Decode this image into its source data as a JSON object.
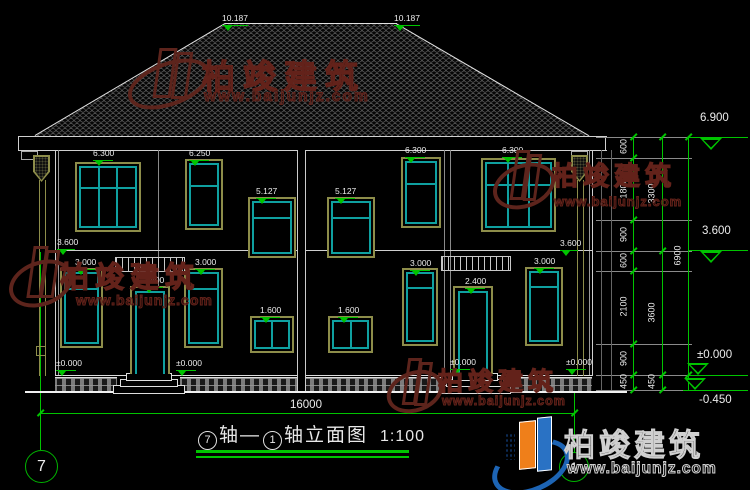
{
  "title": {
    "axis_left": "7",
    "joiner": "轴—",
    "axis_right": "1",
    "suffix": "轴立面图",
    "scale": "1:100"
  },
  "watermark": {
    "brand": "柏竣建筑",
    "url": "www.baijunjz.com"
  },
  "axis_bubbles": {
    "left": "7",
    "right": "1"
  },
  "colors": {
    "dim_green": "#00c400",
    "window_teal": "#0fa0a0",
    "frame_olive": "#8d8d4a",
    "watermark_maroon": "#5d241c",
    "logo_blue": "#1d64b4",
    "logo_orange": "#ef7f1a"
  },
  "elevation_marks": {
    "ridge": [
      "10.187",
      "10.187"
    ],
    "upper_windows": [
      "6.300",
      "6.250",
      "5.127",
      "5.127",
      "6.300",
      "6.300"
    ],
    "mid_floor": [
      "3.600",
      "3.600"
    ],
    "lower_windows": [
      "3.000",
      "3.000",
      "1.600",
      "1.600",
      "3.000",
      "3.000"
    ],
    "doors": [
      "2.400",
      "2.400"
    ],
    "ground": [
      "±0.000",
      "±0.000",
      "±0.000",
      "±0.000"
    ]
  },
  "dim_right": {
    "segments_inner": [
      "600",
      "1800",
      "900",
      "600",
      "2100",
      "900",
      "450"
    ],
    "segments_mid": [
      "3300",
      "3600",
      "450"
    ],
    "total": "6900",
    "levels": [
      "6.900",
      "3.600",
      "±0.000",
      "-0.450"
    ]
  },
  "dim_bottom": {
    "total": "16000"
  }
}
